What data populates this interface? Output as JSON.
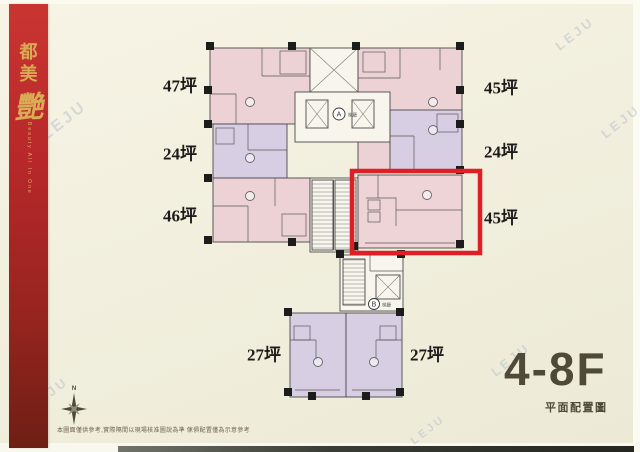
{
  "banner": {
    "title_chars": [
      "都",
      "美",
      "艷"
    ],
    "subtitle": "Beauty All In One"
  },
  "watermark": {
    "text": "LEJU"
  },
  "plan": {
    "labels": {
      "u47": "47坪",
      "u45_tr": "45坪",
      "u24_l": "24坪",
      "u24_r": "24坪",
      "u46": "46坪",
      "u45_hl": "45坪",
      "u27_l": "27坪",
      "u27_r": "27坪"
    },
    "core_a": {
      "letter": "A",
      "label": "梯廳"
    },
    "core_b": {
      "letter": "B",
      "label": "梯廳"
    }
  },
  "footer": {
    "floor_range": "4-8F",
    "caption": "平面配置圖",
    "compass_n": "N",
    "disclaimer": "本圖面僅供參考,實際隔間以現場核准圖說為準 傢俱配置僅為示意參考"
  },
  "colors": {
    "highlight_red": "#e01e25",
    "unit_pink": "#ecd2d4",
    "unit_purple": "#d7cee3",
    "banner_red": "#b8282a",
    "banner_gold": "#d9ab55",
    "footer_text": "#4e4939",
    "paper": "#f2efde"
  }
}
